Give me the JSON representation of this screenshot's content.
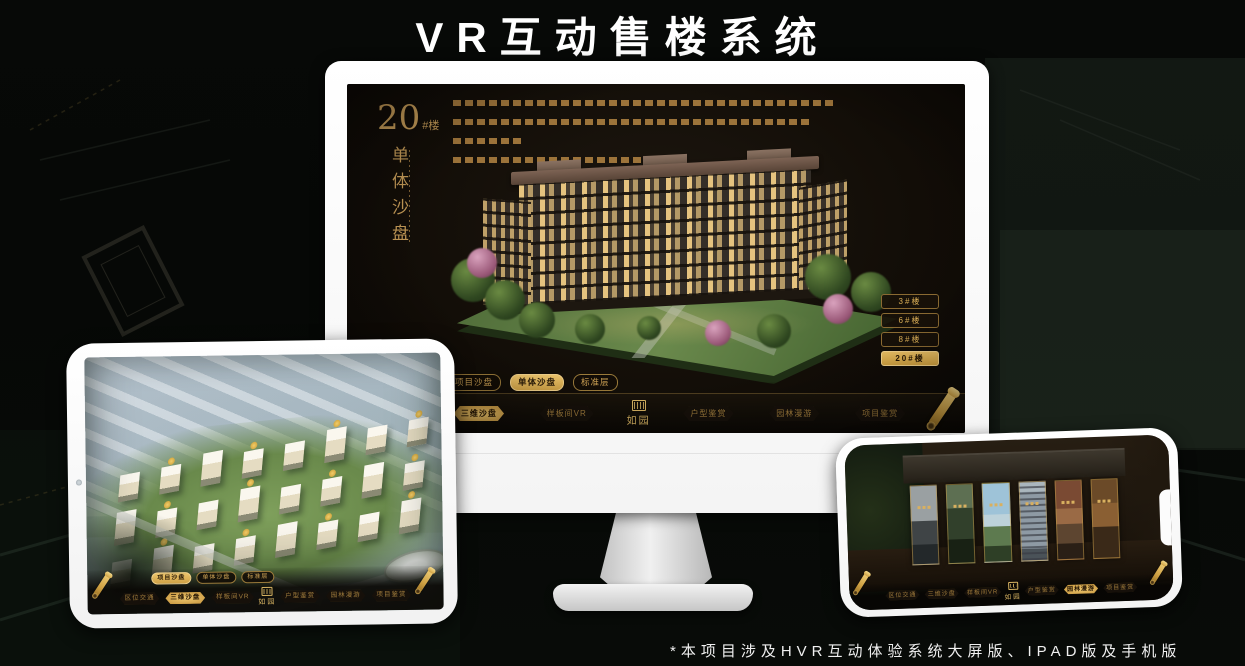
{
  "banner": {
    "title": "VR互动售楼系统"
  },
  "footnote": "*本项目涉及HVR互动体验系统大屏版、IPAD版及手机版",
  "brand": {
    "logo": "如园"
  },
  "colors": {
    "gold": "#c9a35c",
    "gold_active": "#d9a94e",
    "screen_bg": "#141008"
  },
  "monitor": {
    "building_title": {
      "number": "20",
      "suffix": "#楼",
      "subtitle": "单体沙盘"
    },
    "floor_buttons": [
      {
        "label": "3#楼"
      },
      {
        "label": "6#楼"
      },
      {
        "label": "8#楼"
      },
      {
        "label": "20#楼"
      }
    ],
    "subtabs": [
      {
        "label": "项目沙盘"
      },
      {
        "label": "单体沙盘"
      },
      {
        "label": "标准层"
      }
    ],
    "nav_items": [
      {
        "label": "区位交通"
      },
      {
        "label": "三维沙盘"
      },
      {
        "label": "样板间VR"
      },
      {
        "label": "户型鉴赏"
      },
      {
        "label": "园林漫游"
      },
      {
        "label": "项目鉴赏"
      }
    ]
  },
  "tablet": {
    "subtabs": [
      {
        "label": "项目沙盘"
      },
      {
        "label": "单体沙盘"
      },
      {
        "label": "标准层"
      }
    ],
    "nav_items": [
      {
        "label": "区位交通"
      },
      {
        "label": "三维沙盘"
      },
      {
        "label": "样板间VR"
      },
      {
        "label": "户型鉴赏"
      },
      {
        "label": "园林漫游"
      },
      {
        "label": "项目鉴赏"
      }
    ]
  },
  "phone": {
    "nav_items": [
      {
        "label": "区位交通"
      },
      {
        "label": "三维沙盘"
      },
      {
        "label": "样板间VR"
      },
      {
        "label": "户型鉴赏"
      },
      {
        "label": "园林漫游"
      },
      {
        "label": "项目鉴赏"
      }
    ]
  }
}
